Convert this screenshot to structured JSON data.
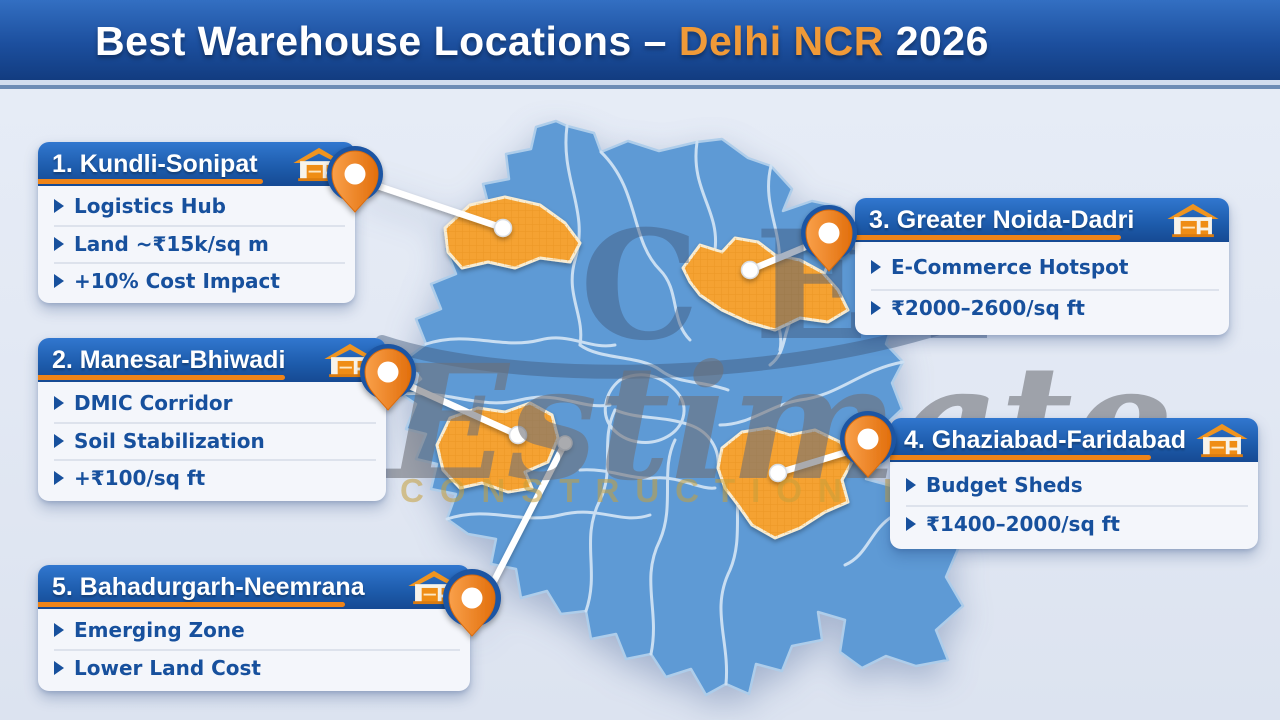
{
  "header": {
    "title_prefix": "Best Warehouse Locations – ",
    "title_highlight": "Delhi NCR",
    "title_suffix": " 2026"
  },
  "watermark": {
    "logo": "CEI",
    "script_text": "Estimate",
    "sub_text": "CONSTRUCTION INC"
  },
  "cards": [
    {
      "title": "1. Kundli-Sonipat",
      "points": [
        "Logistics Hub",
        "Land ~₹15k/sq m",
        "+10% Cost Impact"
      ]
    },
    {
      "title": "2. Manesar-Bhiwadi",
      "points": [
        "DMIC Corridor",
        "Soil Stabilization",
        "+₹100/sq ft"
      ]
    },
    {
      "title": "3. Greater Noida-Dadri",
      "points": [
        "E-Commerce Hotspot",
        "₹2000–2600/sq ft"
      ]
    },
    {
      "title": "4. Ghaziabad-Faridabad",
      "points": [
        "Budget Sheds",
        "₹1400–2000/sq ft"
      ]
    },
    {
      "title": "5. Bahadurgarh-Neemrana",
      "points": [
        "Emerging Zone",
        "Lower Land Cost"
      ]
    }
  ],
  "colors": {
    "bar": "#1c4f9e",
    "accent": "#ef8418",
    "hl": "#f09a38",
    "chead": "#1d5bab",
    "ctext": "#17509d",
    "map": "#5e9ad5",
    "mapline": "#cfe2f4",
    "region": "#f5a230",
    "pin": "#ee7d1e",
    "bg": "#e3e9f4"
  }
}
